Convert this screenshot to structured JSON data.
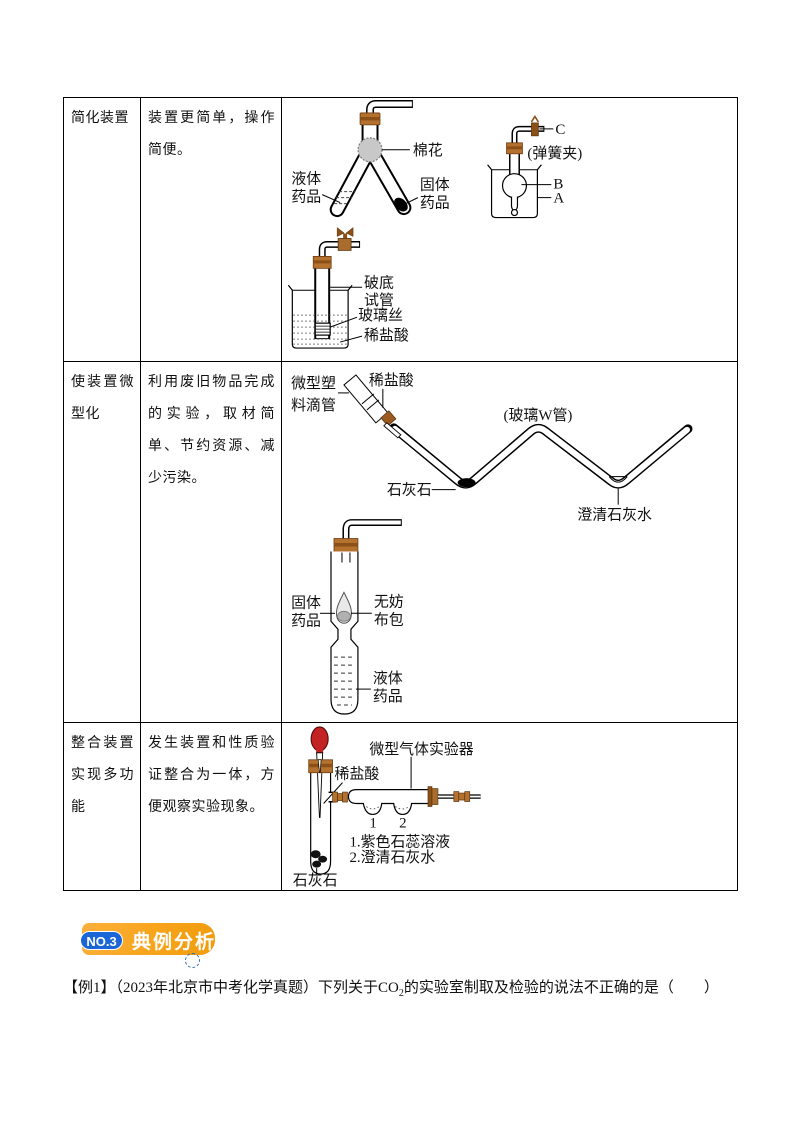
{
  "table": {
    "rows": [
      {
        "feature": "简化装置",
        "description": "装置更简单，操作简便。",
        "labels": {
          "cotton": "棉花",
          "liquid1": "液体",
          "liquid2": "药品",
          "solid1": "固体",
          "solid2": "药品",
          "c": "C",
          "spring_clip": "(弹簧夹)",
          "b": "B",
          "a": "A",
          "broken1": "破底",
          "broken2": "试管",
          "glass_wool": "玻璃丝",
          "acid": "稀盐酸"
        }
      },
      {
        "feature": "使装置微型化",
        "description": "利用废旧物品完成的实验，取材简单、节约资源、减少污染。",
        "labels": {
          "dropper1": "微型塑",
          "dropper2": "料滴管",
          "acid": "稀盐酸",
          "w_tube": "(玻璃W管)",
          "limestone": "石灰石",
          "limewater": "澄清石灰水",
          "solid1": "固体",
          "solid2": "药品",
          "bag1": "无妨",
          "bag2": "布包",
          "liquid1": "液体",
          "liquid2": "药品"
        }
      },
      {
        "feature": "整合装置实现多功能",
        "description": "发生装置和性质验证整合为一体，方便观察实验现象。",
        "labels": {
          "acid": "稀盐酸",
          "device": "微型气体实验器",
          "n1": "1",
          "n2": "2",
          "note1": "1.紫色石蕊溶液",
          "note2": "2.澄清石灰水",
          "limestone": "石灰石"
        }
      }
    ]
  },
  "badge": {
    "number": "NO.3",
    "title": "典例分析"
  },
  "example": {
    "tag": "【例1】",
    "prefix": "（2023年北京市中考化学真题）下列关于CO",
    "sub": "2",
    "suffix": "的实验室制取及检验的说法不正确的是（　　）"
  },
  "colors": {
    "accent_orange": "#F8A41B",
    "accent_blue": "#1A66D9",
    "stopper_brown": "#B5722F",
    "bulb_red": "#C42323"
  }
}
